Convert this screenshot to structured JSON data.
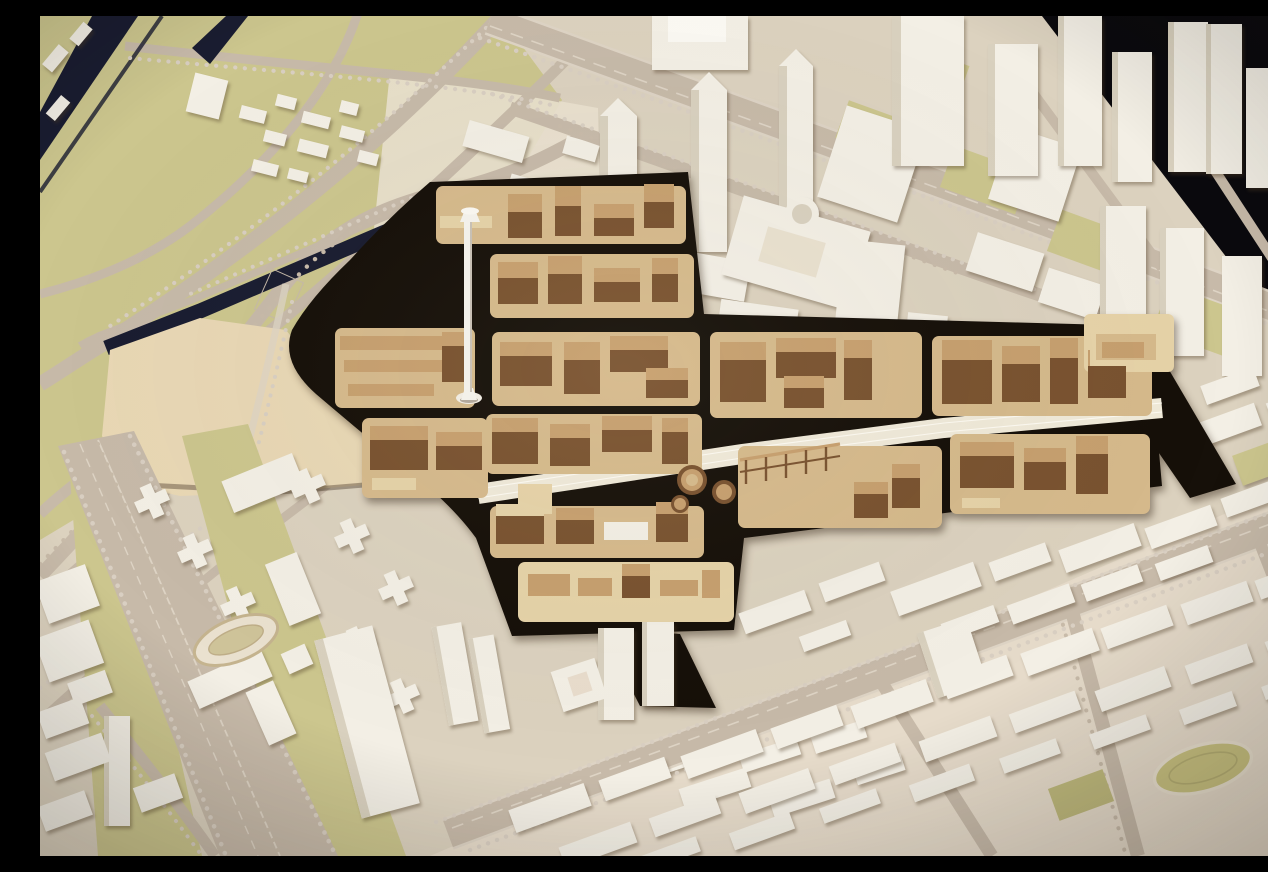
{
  "scene": {
    "description": "Oblique aerial photograph of a physical urban master-plan scale model: a central redevelopment district built of brown laser-cut plywood with black streets and a tall white landmark mast, surrounded by an existing city modelled in white and cream blocks on a beige baseboard, with a motorway interchange and dark canals at the upper left, tree-lined boulevards, olive-green open spaces, two oval running tracks, and a black studio backdrop visible at the upper corners.",
    "subject": "architectural city model",
    "focus_area": "brown plywood redevelopment district",
    "landmark": "white mast tower",
    "industrial_relics": "wooden gasometer cylinders and gantry",
    "infrastructure": "railway corridor crossing the district"
  },
  "regions": {
    "backdrop": "studio backdrop",
    "interchange": "motorway interchange with canals",
    "empty_site": "cleared plywood development site",
    "wood_district": "new masterplan district in brown wood",
    "north_city": "white towers along northern boulevard",
    "east_city": "eastern high-rise cluster",
    "southwest_city": "cross-plan housing towers and boulevard",
    "southeast_city": "dense low-rise perimeter blocks",
    "tracks": "oval running tracks"
  },
  "palette": {
    "backdrop": "#0b0a0e",
    "board": "#dcd2bf",
    "board_light": "#eae1cf",
    "bottom_wash": "#e9ddcd",
    "olive": "#ccc68e",
    "olive_dark": "#bfb97d",
    "canal": "#1a1d31",
    "road": "#c7baa9",
    "road_light": "#ded4c5",
    "tree": "#d9cfc2",
    "tree_dark": "#c8bba9",
    "plate": "#d6ba8c",
    "wood_face": "#7a5330",
    "wood_top": "#c7a06f",
    "wood_light": "#e6d3a8",
    "street": "#161009",
    "white_face": "#f3efe5",
    "white_side": "#d9d1bf",
    "white_top": "#fbf9f3",
    "rail": "#f0ead9",
    "mast": "#f6f4ee",
    "track_green": "#c9c281",
    "field_wood": "#e9d8b5"
  }
}
